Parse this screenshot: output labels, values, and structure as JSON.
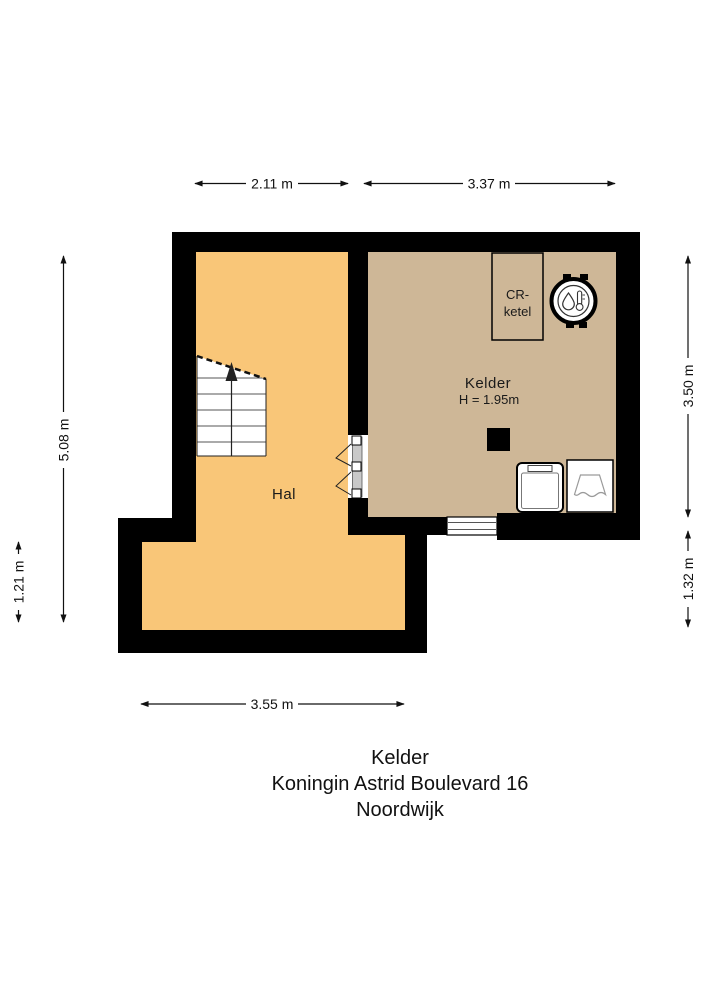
{
  "plan": {
    "rooms": {
      "hal": {
        "label": "Hal"
      },
      "kelder": {
        "label": "Kelder",
        "ceiling_height": "H = 1.95m"
      }
    },
    "boiler": {
      "label_line1": "CR-",
      "label_line2": "ketel"
    },
    "dimensions": {
      "top_left": "2.11 m",
      "top_right": "3.37 m",
      "left_outer": "5.08 m",
      "left_lower": "1.21 m",
      "right_upper": "3.50 m",
      "right_lower": "1.32 m",
      "bottom": "3.55 m"
    },
    "colors": {
      "wall": "#000000",
      "hal_floor": "#F9C678",
      "kelder_floor": "#CEB797"
    }
  },
  "title_block": {
    "room": "Kelder",
    "address": "Koningin Astrid Boulevard 16",
    "city": "Noordwijk"
  }
}
